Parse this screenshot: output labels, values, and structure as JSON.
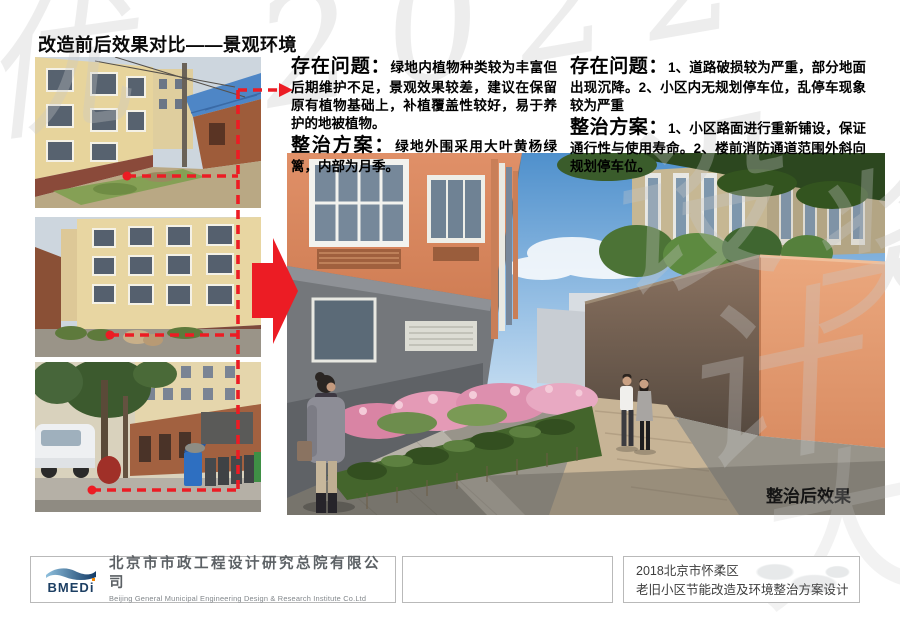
{
  "title": "改造前后效果对比——景观环境",
  "panels": [
    {
      "heading1": "存在问题：",
      "body1": "绿地内植物种类较为丰富但后期维护不足，景观效果较差，建议在保留原有植物基础上，补植覆盖性较好，易于养护的地被植物。",
      "heading2": "整治方案：",
      "body2": "绿地外围采用大叶黄杨绿篱，内部为月季。"
    },
    {
      "heading1": "存在问题：",
      "body1": "1、道路破损较为严重，部分地面出现沉降。2、小区内无规划停车位，乱停车现象较为严重",
      "heading2": "整治方案：",
      "body2": "1、小区路面进行重新铺设，保证通行性与使用寿命。2、楼前消防通道范围外斜向规划停车位。"
    }
  ],
  "after_label": "整治后效果",
  "footer": {
    "logo_text": "BMEDi",
    "company_cn": "北京市市政工程设计研究总院有限公司",
    "company_en": "Beijing General Municipal Engineering Design & Research Institute Co.Ltd",
    "project_line1": "2018北京市怀柔区",
    "project_line2": "老旧小区节能改造及环境整治方案设计"
  },
  "watermark": {
    "chars": [
      "优",
      "2022",
      "设",
      "计",
      "大",
      "奖"
    ]
  },
  "colors": {
    "accent_red": "#e8130c",
    "logo_navy": "#1d3f63",
    "logo_orange": "#f08300",
    "watermark_gray": "#c9c9c9"
  }
}
